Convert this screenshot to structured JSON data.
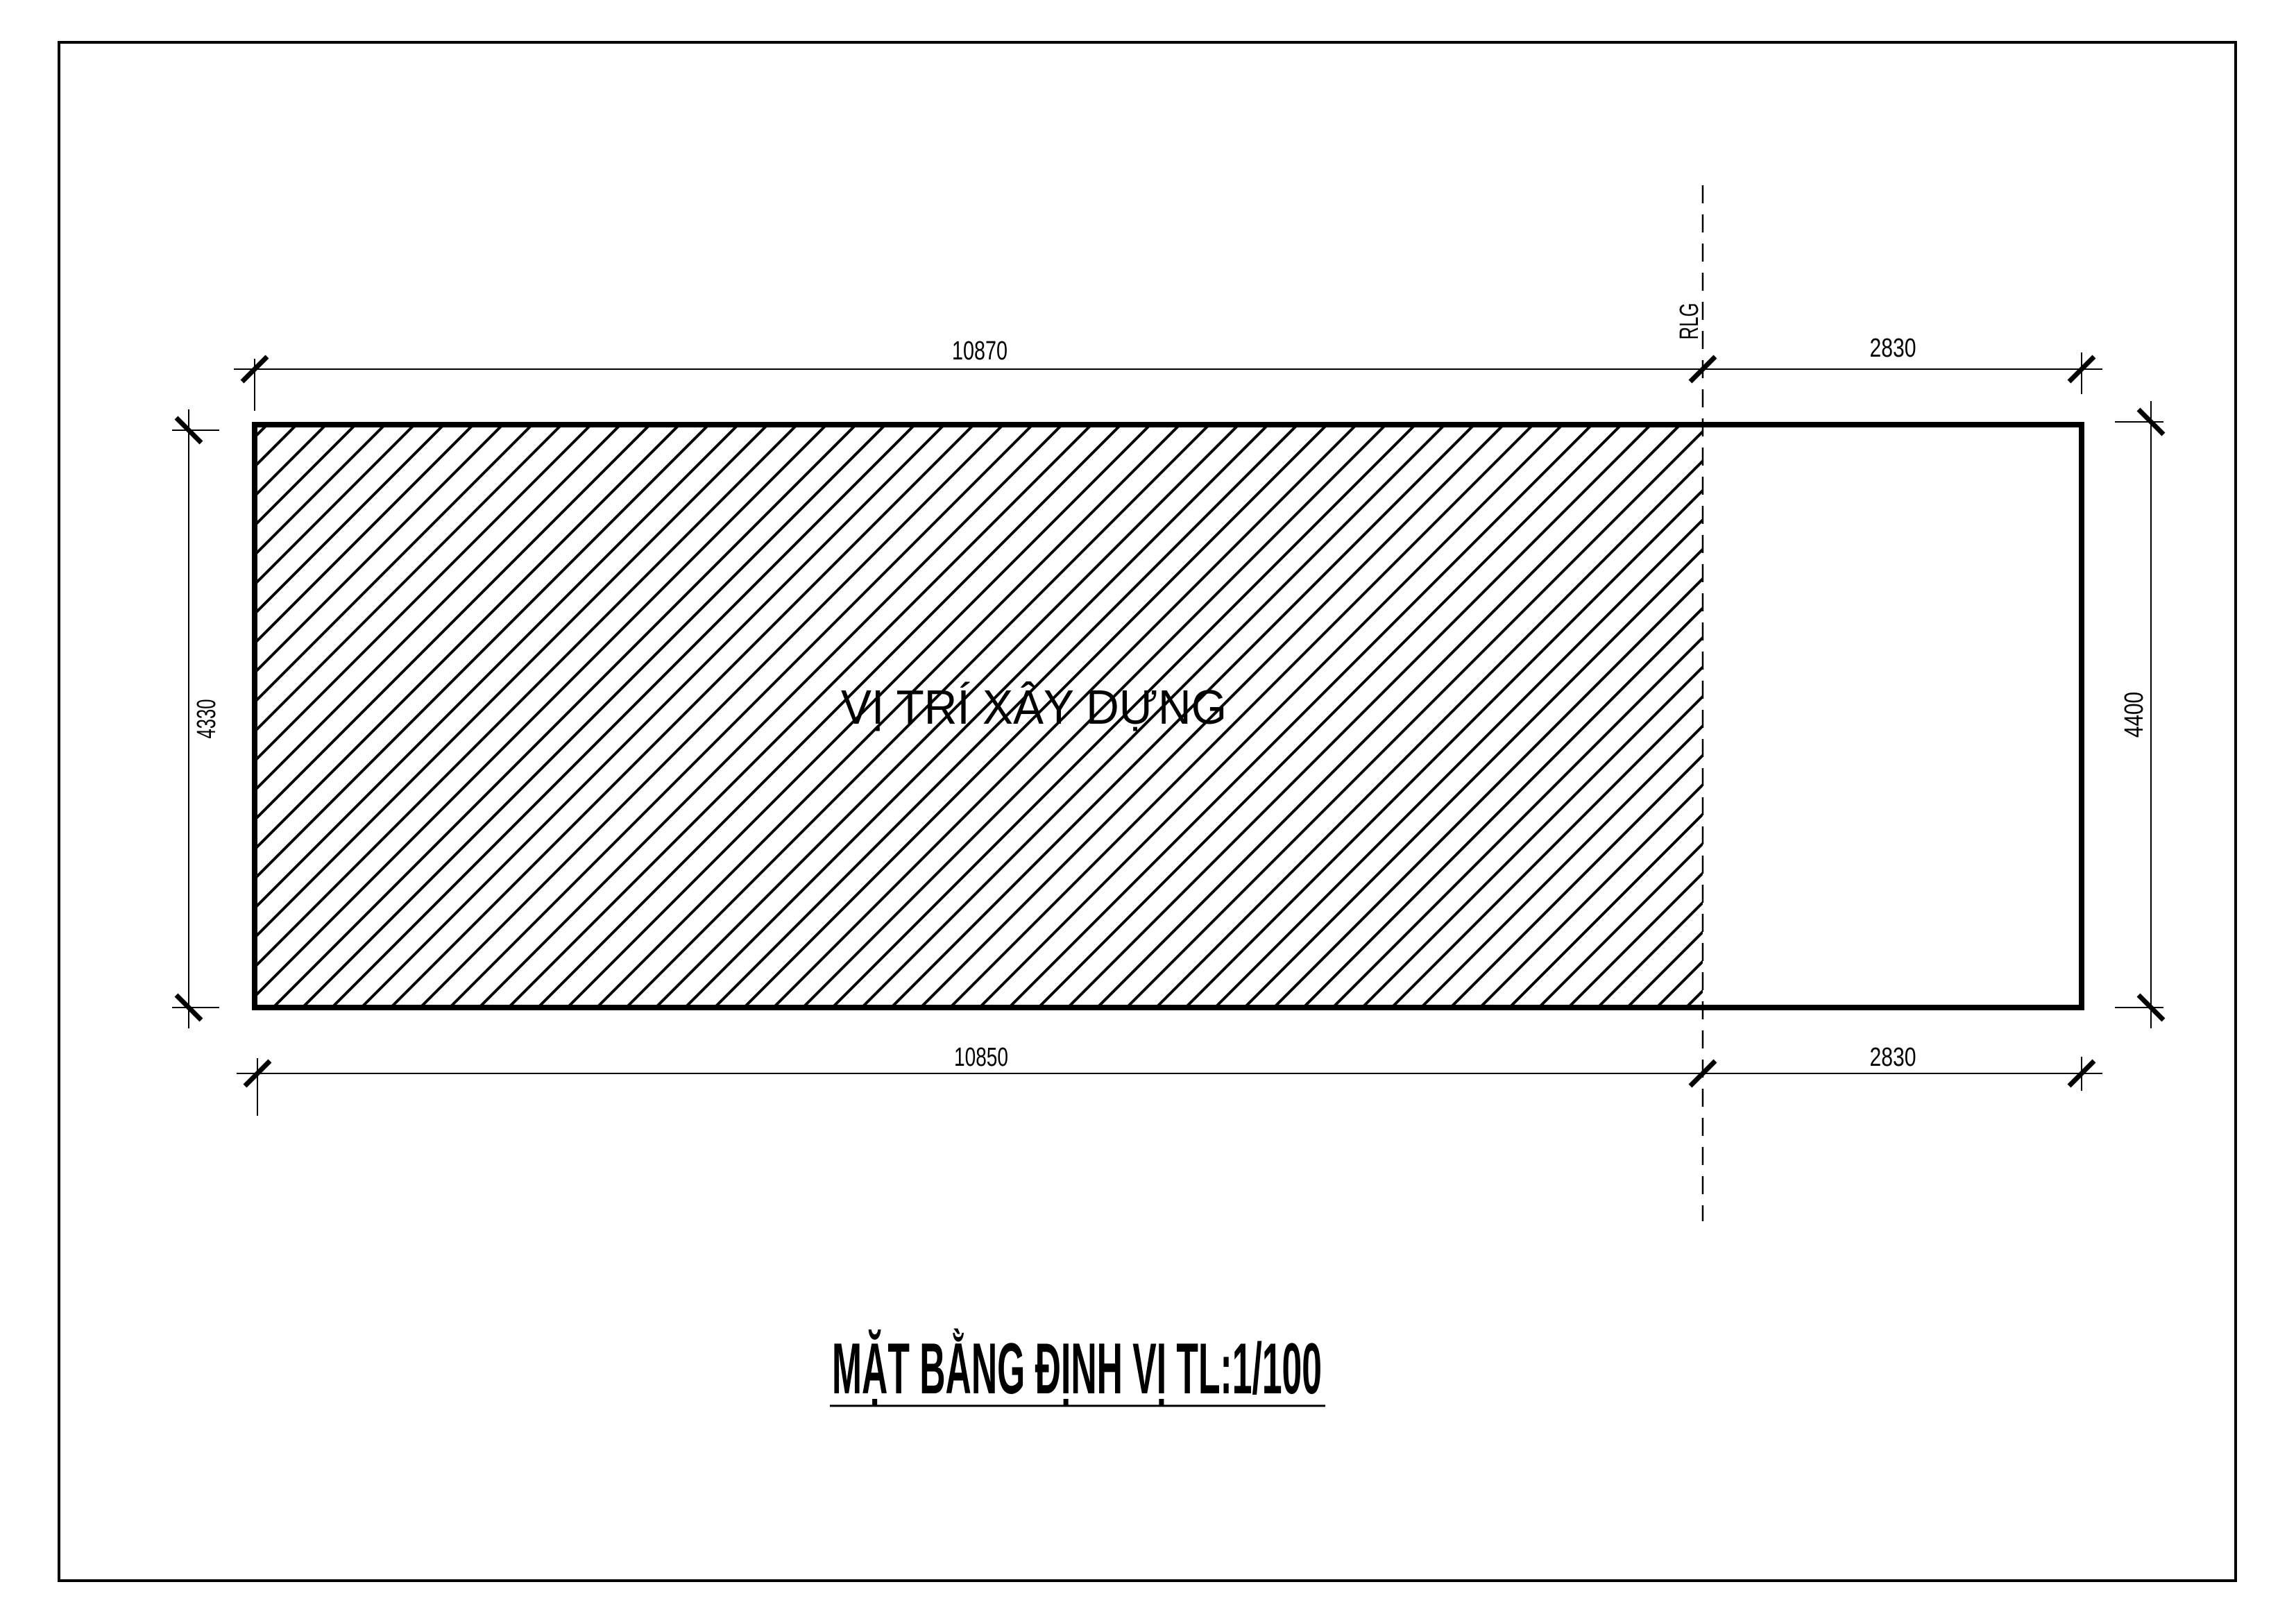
{
  "drawing": {
    "title": "MẶT BẰNG ĐỊNH VỊ TL:1/100",
    "site_label": "VỊ TRÍ XÂY DỰNG",
    "boundary_line_label": "RLG",
    "dimensions": {
      "top_width": "10870",
      "top_right_width": "2830",
      "bottom_width": "10850",
      "bottom_right_width": "2830",
      "left_height": "4330",
      "right_height": "4400"
    },
    "colors": {
      "line": "#000000",
      "paper": "#ffffff"
    }
  }
}
